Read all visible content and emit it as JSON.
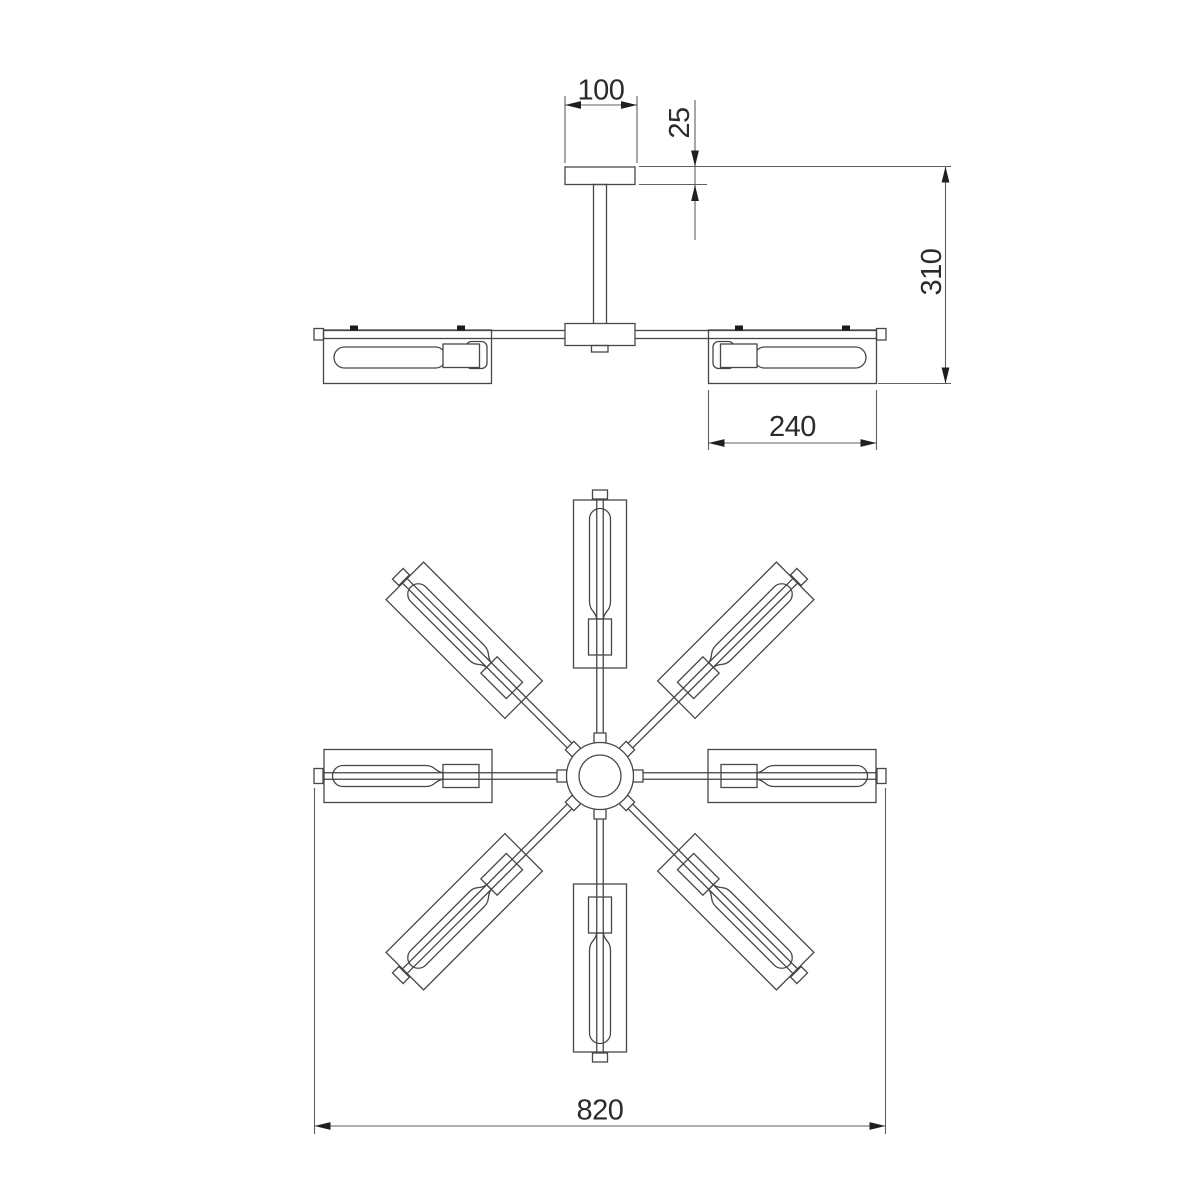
{
  "drawing": {
    "kind": "technical dimension drawing (ceiling light fixture)",
    "views": {
      "side": "side elevation",
      "plan": "bottom plan"
    },
    "plan": {
      "arm_count": 8
    }
  },
  "dimensions": {
    "canopy_width": "100",
    "canopy_height": "25",
    "overall_height": "310",
    "shade_length": "240",
    "overall_diameter": "820"
  },
  "colors": {
    "background": "#ffffff",
    "geometry": "#474747",
    "dimension": "#5f5f5f",
    "arrow": "#1f1f1f",
    "text": "#2b2b2b",
    "screw": "#1a1a1a"
  }
}
